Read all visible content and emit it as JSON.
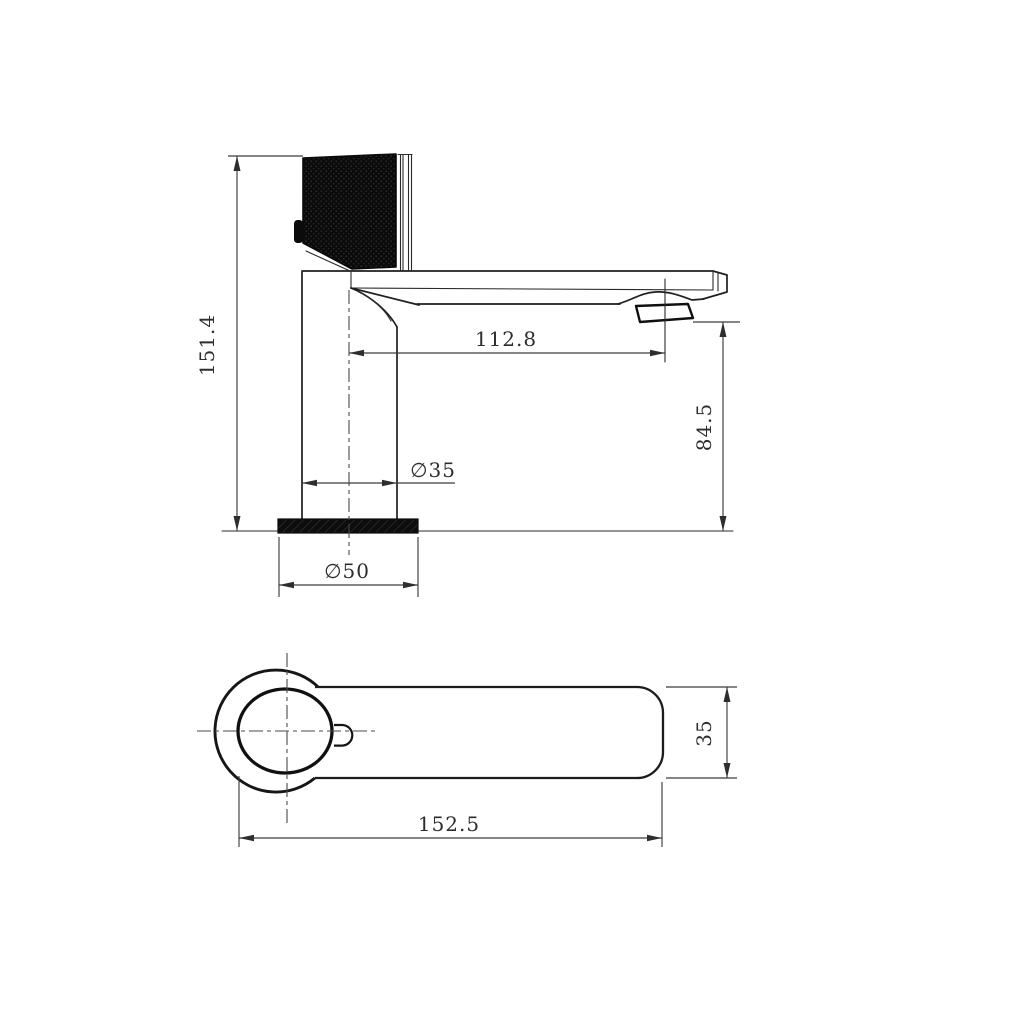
{
  "drawing": {
    "title": "faucet-technical-drawing",
    "side_view": {
      "dim_total_height": "151.4",
      "dim_spout_reach": "112.8",
      "dim_outlet_height": "84.5",
      "dim_body_diameter": "∅35",
      "dim_base_diameter": "∅50"
    },
    "top_view": {
      "dim_total_length": "152.5",
      "dim_spout_width": "35"
    },
    "colors": {
      "outline": "#1f1f1f",
      "dimension_line": "#3c3c3c",
      "dark_fill": "#0b0b0b",
      "background": "#ffffff"
    }
  }
}
